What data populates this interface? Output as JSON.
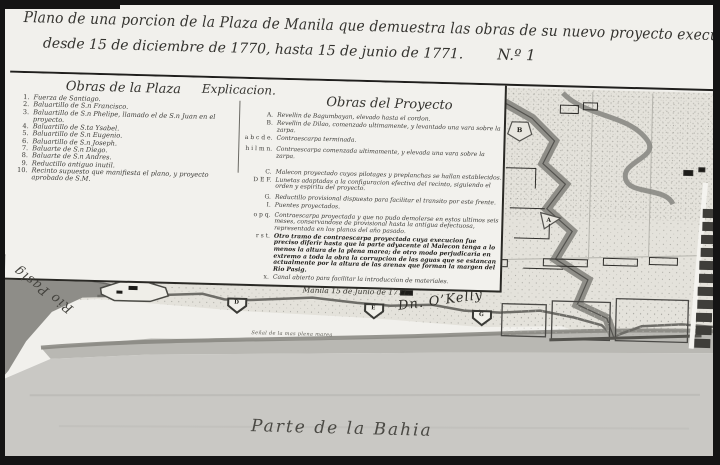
{
  "title": {
    "line1": "Plano de una porcion de la Plaza de Manila que demuestra las obras de su nuevo proyecto executadas",
    "line2": "desde 15 de diciembre de 1770, hasta 15 de junio de 1771.",
    "number": "N.º 1"
  },
  "legend": {
    "explicacion_header": "Explicacion.",
    "plaza": {
      "header": "Obras de la Plaza",
      "items": [
        {
          "num": "1.",
          "text": "Fuerza de Santiago."
        },
        {
          "num": "2.",
          "text": "Baluartillo de S.n Francisco."
        },
        {
          "num": "3.",
          "text": "Baluartillo de S.n Phelipe, llamado el de S.n Juan en el proyecto."
        },
        {
          "num": "4.",
          "text": "Baluartillo de S.ta Ysabel."
        },
        {
          "num": "5.",
          "text": "Baluartillo de S.n Eugenio."
        },
        {
          "num": "6.",
          "text": "Baluartillo de S.n Joseph."
        },
        {
          "num": "7.",
          "text": "Baluarte de S.n Diego."
        },
        {
          "num": "8.",
          "text": "Baluarte de S.n Andres."
        },
        {
          "num": "9.",
          "text": "Reductillo antiguo inutil."
        },
        {
          "num": "10.",
          "text": "Recinto supuesto que manifiesta el plano, y proyecto aprobado de S.M."
        }
      ]
    },
    "proyecto": {
      "header": "Obras del Proyecto",
      "items": [
        {
          "key": "A.",
          "text": "Revellin de Bagumbayan, elevado hasta el cordon."
        },
        {
          "key": "B.",
          "text": "Revellin de Dilao, comenzado ultimamente, y levantado una vara sobre la zarpa."
        },
        {
          "key": "a b c d e.",
          "text": "Contraescarpa terminada."
        },
        {
          "key": "h i l m n.",
          "text": "Contraescarpa comenzada ultimamente, y elevada una vara sobre la zarpa."
        },
        {
          "key": "C.",
          "text": "Malecon proyectado cuyos pilotages y preplanchas se hallan establecidos."
        },
        {
          "key": "D E F.",
          "text": "Lunetas adaptadas a la configuracion efectiva del recinto, siguiendo el orden y espiritu del proyecto."
        },
        {
          "key": "G.",
          "text": "Reductillo provisional dispuesto para facilitar el transito por este frente."
        },
        {
          "key": "I.",
          "text": "Puentes proyectados."
        },
        {
          "key": "o p q.",
          "text": "Contraescarpa proyectada y que no pudo demolerse en estos ultimos seis meses, conservandose de provisional hasta la antigua defectuosa, representada en los planos del año pasado."
        },
        {
          "key": "r s t.",
          "text": "Otro tramo de contraescarpa proyectada cuya execucion fue preciso diferir hasta que la parte adyacente al Malecon tenga a lo menos la altura de la plena marea; de otro modo perjudicaria en extremo a toda la obra la corrupcion de las aguas que se estancan actualmente por la altura de las arenas que forman la margen del Rio Pasig."
        },
        {
          "key": "x.",
          "text": "Canal abierto para facilitar la introduccion de materiales."
        }
      ]
    },
    "date_line": "Manila 15 de Junio de 1771.",
    "signature": "Dn. O’Kelly"
  },
  "map": {
    "labels": {
      "rio": "Rio Pasig",
      "bahia": "Parte de la Bahia",
      "marea": "Señal de la mas plena marea"
    },
    "markers": {
      "ravelin_b": "B",
      "ravelin_a": "A",
      "redan_d": "D",
      "redan_e": "E",
      "redan_g": "G"
    }
  },
  "colors": {
    "frame": "#141414",
    "paper": "#f1f0ec",
    "ink": "#34332f",
    "river": "#8e8d88",
    "bay": "#c9c8c4",
    "beach": "#b9b8b3",
    "rampart": "#8f8e88",
    "terrain": "#e4e2db"
  }
}
